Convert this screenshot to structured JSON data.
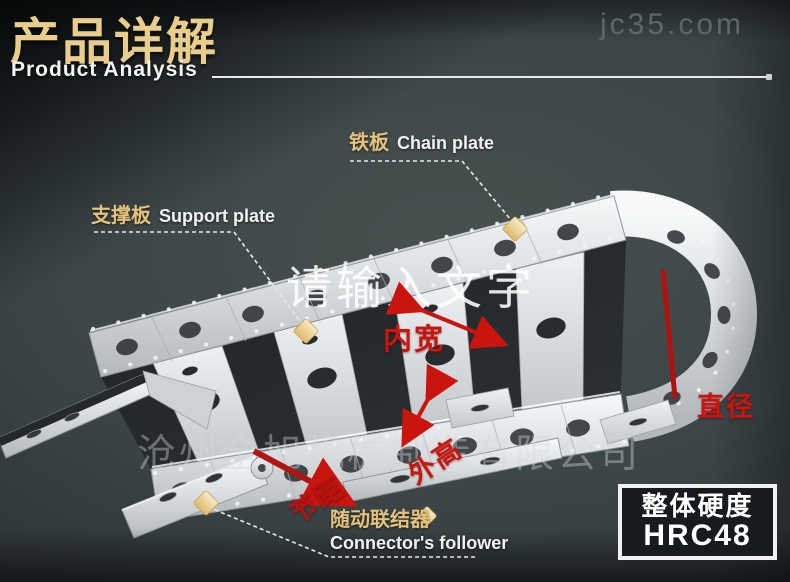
{
  "header": {
    "title_cn": "产品详解",
    "title_en": "Product Analysis"
  },
  "watermarks": {
    "site": "jc35.com",
    "placeholder": "请输入文字",
    "company": "沧州全旭机械制造有限公司"
  },
  "labels": {
    "chain_plate": {
      "cn": "铁板",
      "en": "Chain plate"
    },
    "support_plate": {
      "cn": "支撑板",
      "en": "Support plate"
    },
    "inner_width": "内宽",
    "diameter": "直径",
    "outer_height": "外高",
    "pitch": "节距",
    "follower": {
      "cn": "随动联结器",
      "en": "Connector's follower"
    }
  },
  "badge": {
    "line1": "整体硬度",
    "line2": "HRC48"
  },
  "colors": {
    "accent_gold": "#e9cd8d",
    "label_red": "#c9150e",
    "background": "#3c4547",
    "metal_light": "#f6f8f9",
    "marker_diamond": "#f3dfae"
  }
}
